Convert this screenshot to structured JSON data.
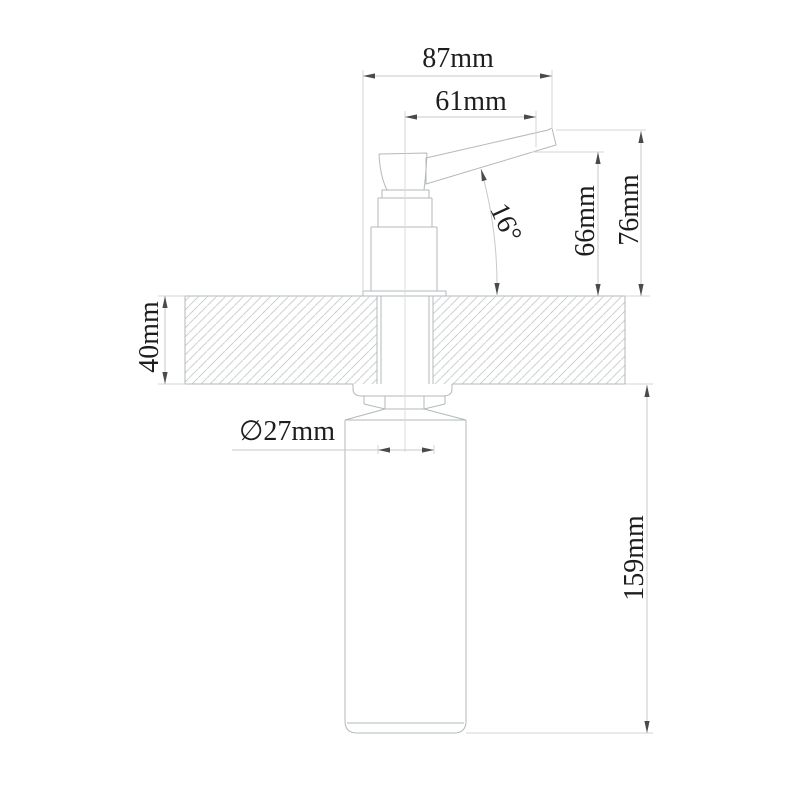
{
  "drawing": {
    "kind": "technical dimension drawing",
    "subject": "deck-mounted soap dispenser, side elevation with counter cross-section",
    "palette": {
      "background": "#ffffff",
      "object_line": "#b3b9b9",
      "dimension_line": "#c6cacb",
      "extension_line": "#d2d6d7",
      "hatch_line": "#cdd1d2",
      "arrow": "#4a4a4a",
      "text": "#1e1e1e"
    },
    "labels": {
      "overall_width": "87mm",
      "spout_reach": "61mm",
      "spout_angle": "16°",
      "outlet_height": "66mm",
      "spout_top_height": "76mm",
      "deck_thickness": "40mm",
      "shank_diameter": "∅27mm",
      "under_counter_length": "159mm"
    }
  }
}
